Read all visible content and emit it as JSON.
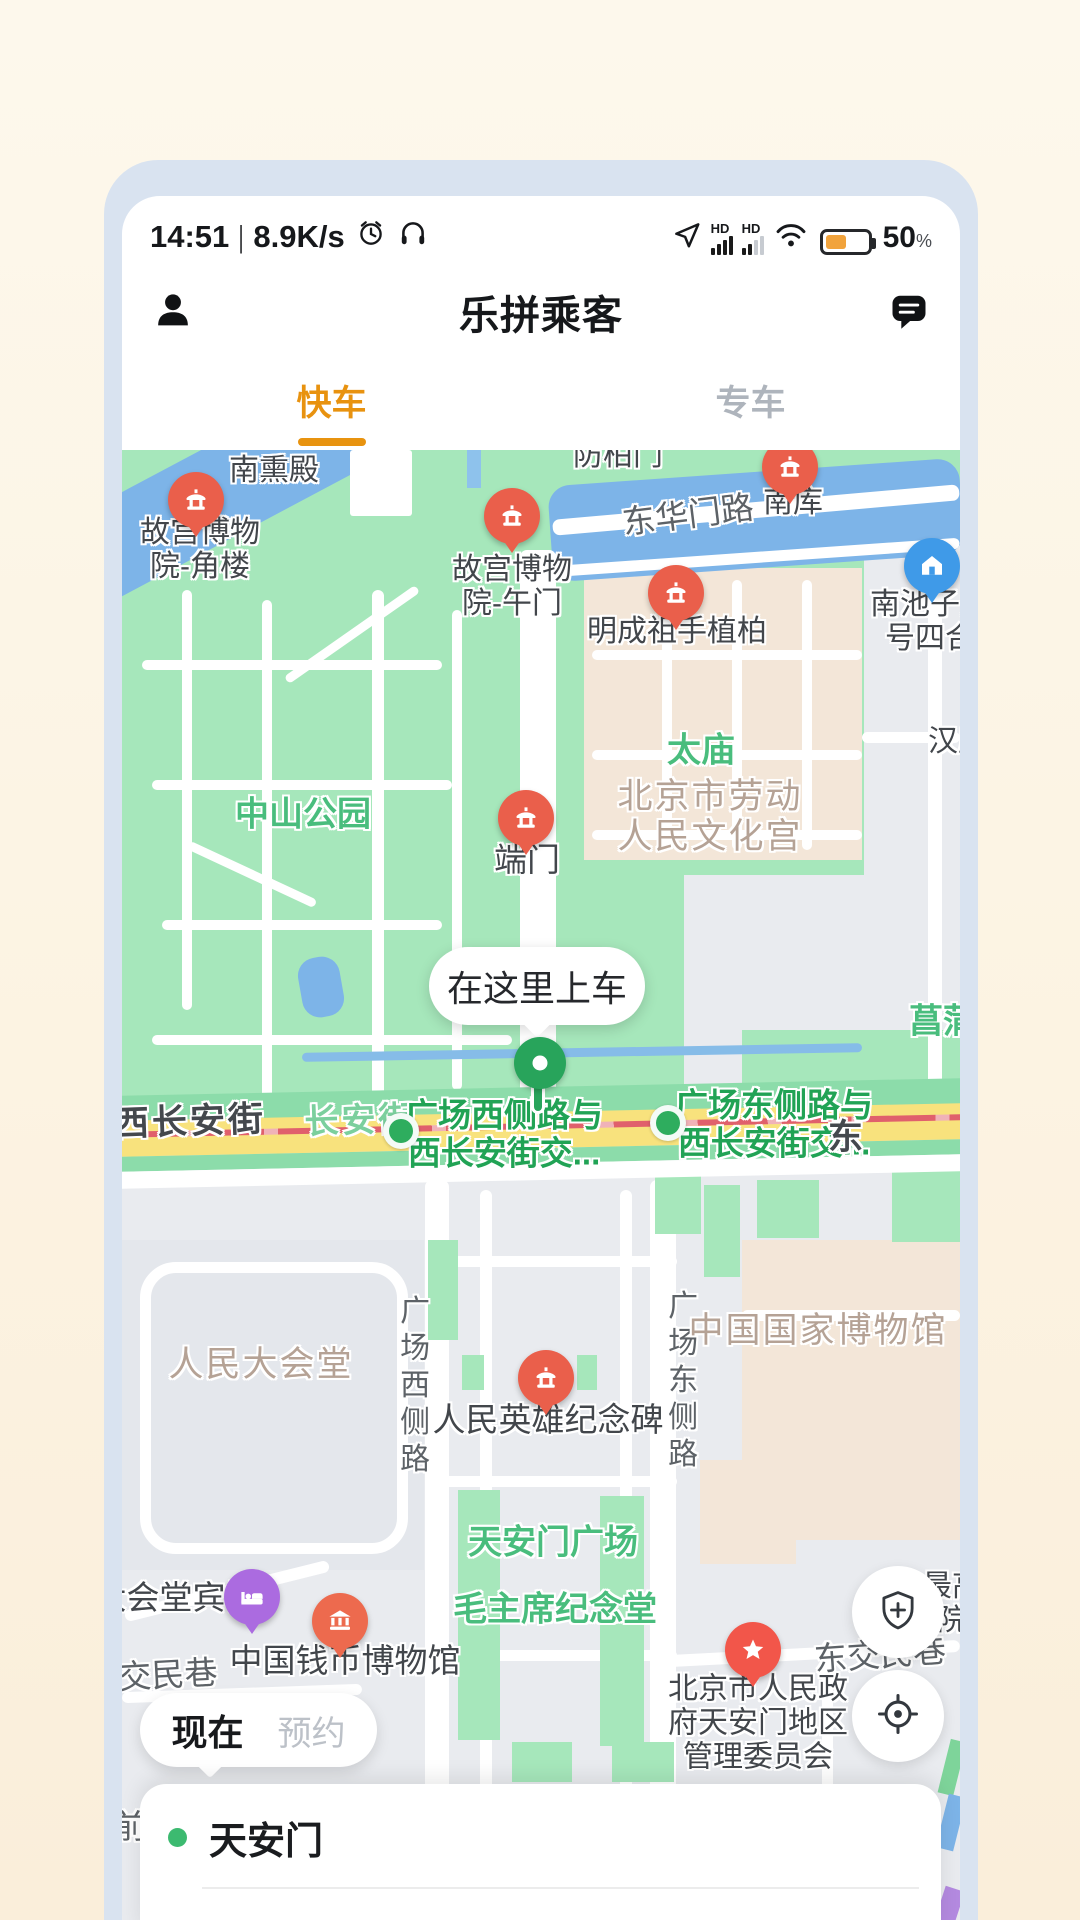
{
  "statusbar": {
    "time": "14:51",
    "sep": "|",
    "speed": "8.9K/s",
    "battery": "50",
    "percent": "%",
    "icons": [
      "alarm-clock",
      "headphones",
      "gps-arrow",
      "signal-hd",
      "signal-hd",
      "wifi",
      "battery"
    ]
  },
  "header": {
    "title": "乐拼乘客"
  },
  "tabs": {
    "fast": "快车",
    "premium": "专车"
  },
  "map": {
    "bubble": "在这里上车",
    "labels": [
      {
        "name": "nanxundian",
        "cls": "",
        "x": 152,
        "y": 21,
        "lines": [
          "南熏殿"
        ]
      },
      {
        "name": "gugong-jiaolou",
        "cls": "",
        "x": 78,
        "y": 100,
        "lines": [
          "故宫博物",
          "院-角楼"
        ]
      },
      {
        "name": "gugong-wumen",
        "cls": "",
        "x": 390,
        "y": 137,
        "lines": [
          "故宫博物",
          "院-午门"
        ]
      },
      {
        "name": "baimen",
        "cls": "",
        "x": 496,
        "y": 6,
        "lines": [
          "防柏门"
        ]
      },
      {
        "name": "donghuamen-road",
        "cls": "road-gray lg",
        "x": 566,
        "y": 65,
        "rot": -7,
        "lines": [
          "东华门路"
        ]
      },
      {
        "name": "nanku",
        "cls": "",
        "x": 671,
        "y": 53,
        "lines": [
          "南库"
        ]
      },
      {
        "name": "nanchizi",
        "cls": "",
        "x": 823,
        "y": 172,
        "lines": [
          "南池子大街",
          "号四合院"
        ]
      },
      {
        "name": "mingchengzu",
        "cls": "",
        "x": 555,
        "y": 182,
        "lines": [
          "明成祖手植柏"
        ]
      },
      {
        "name": "taimiao",
        "cls": "area-green lg",
        "x": 579,
        "y": 301,
        "lines": [
          "太庙"
        ]
      },
      {
        "name": "wenhuagong",
        "cls": "area-brown",
        "x": 588,
        "y": 367,
        "lines": [
          "北京市劳动",
          "人民文化宫"
        ]
      },
      {
        "name": "han",
        "cls": "",
        "x": 836,
        "y": 292,
        "lines": [
          "汉庭"
        ]
      },
      {
        "name": "zhongshan-park",
        "cls": "area-green lg",
        "x": 181,
        "y": 365,
        "lines": [
          "中山公园"
        ]
      },
      {
        "name": "duanmen",
        "cls": "lg",
        "x": 405,
        "y": 410,
        "lines": [
          "端门"
        ]
      },
      {
        "name": "changpu",
        "cls": "area-green",
        "x": 838,
        "y": 572,
        "lines": [
          "菖蒲河"
        ]
      },
      {
        "name": "xichanganjie",
        "cls": "road-dark",
        "x": 68,
        "y": 672,
        "rot": -2,
        "lines": [
          "西长安街"
        ]
      },
      {
        "name": "changanjie",
        "cls": "road-onyellow",
        "x": 238,
        "y": 671,
        "rot": -2,
        "lines": [
          "长安街"
        ]
      },
      {
        "name": "junction-west",
        "cls": "junction-green",
        "x": 382,
        "y": 684,
        "lines": [
          "广场西侧路与",
          "西长安街交..."
        ]
      },
      {
        "name": "junction-east",
        "cls": "junction-green",
        "x": 652,
        "y": 674,
        "lines": [
          "广场东侧路与",
          "西长安街交..."
        ]
      },
      {
        "name": "dong",
        "cls": "road-dark",
        "x": 725,
        "y": 688,
        "lines": [
          "东"
        ]
      },
      {
        "name": "renmindahuitang",
        "cls": "area-brown",
        "x": 139,
        "y": 915,
        "lines": [
          "人民大会堂"
        ]
      },
      {
        "name": "gcxi-road",
        "cls": "road-gray vertical",
        "x": 289,
        "y": 937,
        "lines": [
          "广场西侧路"
        ]
      },
      {
        "name": "yingxiongbei",
        "cls": "lg",
        "x": 426,
        "y": 970,
        "lines": [
          "人民英雄纪念碑"
        ]
      },
      {
        "name": "gcdong-road",
        "cls": "road-gray vertical",
        "x": 557,
        "y": 932,
        "lines": [
          "广场东侧路"
        ]
      },
      {
        "name": "guobo",
        "cls": "area-brown",
        "x": 696,
        "y": 881,
        "lines": [
          "中国国家博物馆"
        ]
      },
      {
        "name": "tiananmen-square",
        "cls": "area-green lg",
        "x": 431,
        "y": 1093,
        "lines": [
          "天安门广场"
        ]
      },
      {
        "name": "maozhuxi",
        "cls": "area-green lg",
        "x": 433,
        "y": 1160,
        "lines": [
          "毛主席纪念堂"
        ]
      },
      {
        "name": "dahuitang-hotel",
        "cls": "lg",
        "x": 54,
        "y": 1148,
        "lines": [
          "大会堂宾馆"
        ]
      },
      {
        "name": "jiaominxiang",
        "cls": "road-gray lg",
        "x": 46,
        "y": 1225,
        "rot": -3,
        "lines": [
          "交民巷"
        ]
      },
      {
        "name": "qianbi-museum",
        "cls": "lg",
        "x": 223,
        "y": 1211,
        "lines": [
          "中国钱币博物馆"
        ]
      },
      {
        "name": "guanweihui",
        "cls": "",
        "x": 636,
        "y": 1274,
        "lines": [
          "北京市人民政",
          "府天安门地区",
          "管理委员会"
        ]
      },
      {
        "name": "dongjiaominxiang",
        "cls": "road-gray lg",
        "x": 758,
        "y": 1205,
        "rot": -4,
        "lines": [
          "东交民巷"
        ]
      },
      {
        "name": "zuigao",
        "cls": "",
        "x": 830,
        "y": 1154,
        "lines": [
          "最高",
          "院"
        ]
      },
      {
        "name": "qian",
        "cls": "road-gray lg",
        "x": 8,
        "y": 1377,
        "lines": [
          "前"
        ]
      }
    ],
    "pins": [
      {
        "name": "jiaolou",
        "type": "temple",
        "x": 74,
        "y": 50
      },
      {
        "name": "wumen",
        "type": "temple",
        "x": 390,
        "y": 66
      },
      {
        "name": "nanku",
        "type": "temple",
        "x": 668,
        "y": 17
      },
      {
        "name": "mingchengzu",
        "type": "temple",
        "x": 554,
        "y": 143
      },
      {
        "name": "nanchizi",
        "type": "house",
        "x": 810,
        "y": 116
      },
      {
        "name": "duanmen",
        "type": "temple",
        "x": 404,
        "y": 368
      },
      {
        "name": "yingxiongbei",
        "type": "temple",
        "x": 424,
        "y": 928
      },
      {
        "name": "binguan",
        "type": "bed",
        "x": 130,
        "y": 1147
      },
      {
        "name": "qianbi",
        "type": "bank",
        "x": 218,
        "y": 1171
      },
      {
        "name": "guanweihui",
        "type": "star",
        "x": 631,
        "y": 1200
      }
    ],
    "junction_dots": [
      {
        "name": "west",
        "x": 279,
        "y": 681
      },
      {
        "name": "east",
        "x": 546,
        "y": 673
      }
    ]
  },
  "controls": {
    "now": "现在",
    "reserve": "预约"
  },
  "sheet": {
    "destination": "天安门"
  },
  "colors": {
    "accent_orange": "#e8930f",
    "pickup_green": "#28a45b",
    "park_green": "#a6e7bb",
    "water_blue": "#7db4e8",
    "road_yellow": "#f8e27d",
    "frame_blue": "#d9e3f0"
  }
}
